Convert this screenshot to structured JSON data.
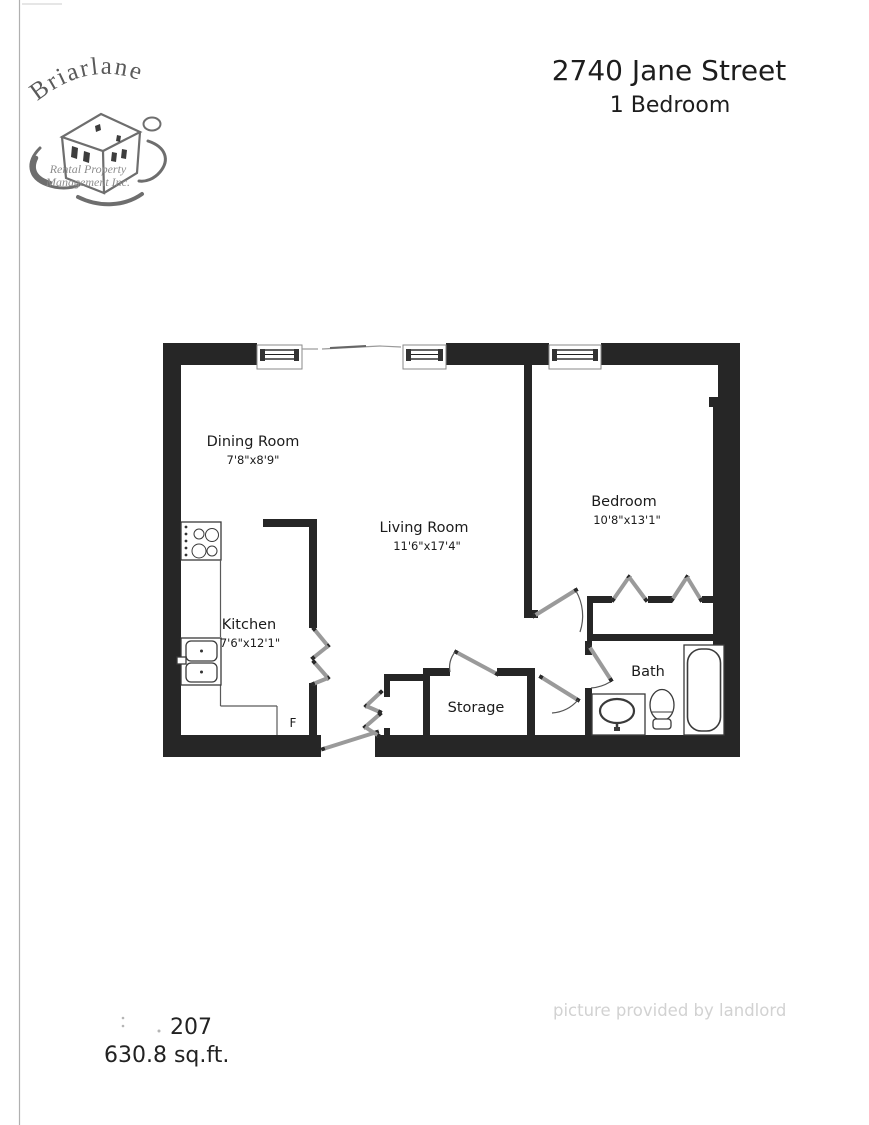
{
  "page": {
    "title": "2740 Jane Street",
    "subtitle": "1 Bedroom",
    "unit_number": "207",
    "unit_area": "630.8 sq.ft.",
    "watermark": "picture provided by landlord"
  },
  "logo": {
    "name": "Briarlane",
    "tagline1": "Rental Property",
    "tagline2": "Management Inc."
  },
  "floorplan": {
    "rooms": {
      "dining": {
        "name": "Dining Room",
        "dims": "7'8\"x8'9\""
      },
      "living": {
        "name": "Living Room",
        "dims": "11'6\"x17'4\""
      },
      "bedroom": {
        "name": "Bedroom",
        "dims": "10'8\"x13'1\""
      },
      "kitchen": {
        "name": "Kitchen",
        "dims": "7'6\"x12'1\""
      },
      "storage": {
        "name": "Storage"
      },
      "bath": {
        "name": "Bath"
      }
    },
    "fridge_label": "F",
    "colors": {
      "wall": "#262626",
      "door_leaf": "#9a9a9a",
      "label_text": "#1b1b1b",
      "watermark": "#d2d2d2"
    }
  }
}
